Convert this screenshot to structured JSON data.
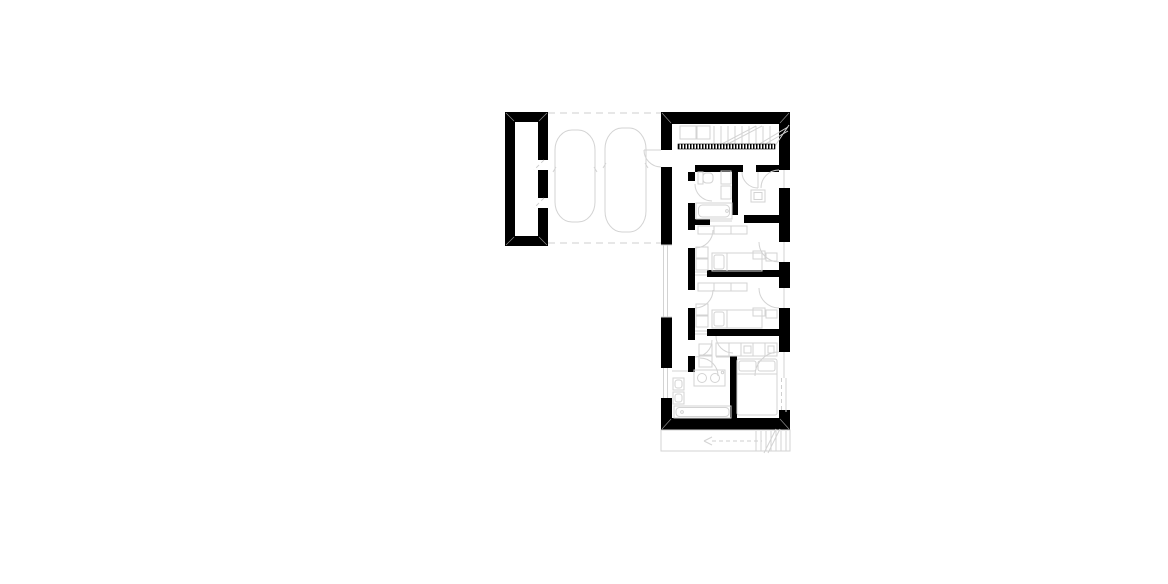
{
  "palette": {
    "background": "#ffffff",
    "wall": "#000000",
    "line": "#d3d3d3",
    "dash_line": "#cfcfcf",
    "miter": "#8a8a8a"
  },
  "plan": {
    "type": "architectural-floor-plan",
    "storeys_visible": 1,
    "text_labels": [],
    "areas": [
      {
        "name": "carport",
        "objects": [
          "storage-room",
          "car-outline",
          "car-outline",
          "dashed-boundary"
        ]
      },
      {
        "name": "entry-hall",
        "objects": [
          "staircase",
          "stair-railing",
          "closet",
          "closet",
          "entrance-door"
        ]
      },
      {
        "name": "bathroom",
        "objects": [
          "toilet",
          "wall-cabinet",
          "wall-cabinet",
          "bathtub",
          "door"
        ]
      },
      {
        "name": "wc-room",
        "objects": [
          "shower",
          "door",
          "exterior-door"
        ]
      },
      {
        "name": "bedroom-1",
        "objects": [
          "closet-row",
          "wardrobe",
          "bed",
          "pillow",
          "nightstand",
          "nightstand",
          "door",
          "terrace-door"
        ]
      },
      {
        "name": "bedroom-2",
        "objects": [
          "closet-row",
          "wardrobe",
          "bed",
          "pillow",
          "nightstand",
          "nightstand",
          "door",
          "terrace-door"
        ]
      },
      {
        "name": "dressing",
        "objects": [
          "closet",
          "closet",
          "door"
        ]
      },
      {
        "name": "ensuite-bathroom",
        "objects": [
          "vanity",
          "sink",
          "sink",
          "toilet",
          "bidet",
          "bathtub",
          "door"
        ]
      },
      {
        "name": "master-bedroom",
        "objects": [
          "wardrobe-row",
          "double-bed",
          "pillow",
          "pillow",
          "door",
          "exterior-door",
          "sliding-glazing"
        ]
      },
      {
        "name": "exterior-stair",
        "objects": [
          "treads",
          "direction-arrow",
          "break-line"
        ]
      }
    ]
  }
}
